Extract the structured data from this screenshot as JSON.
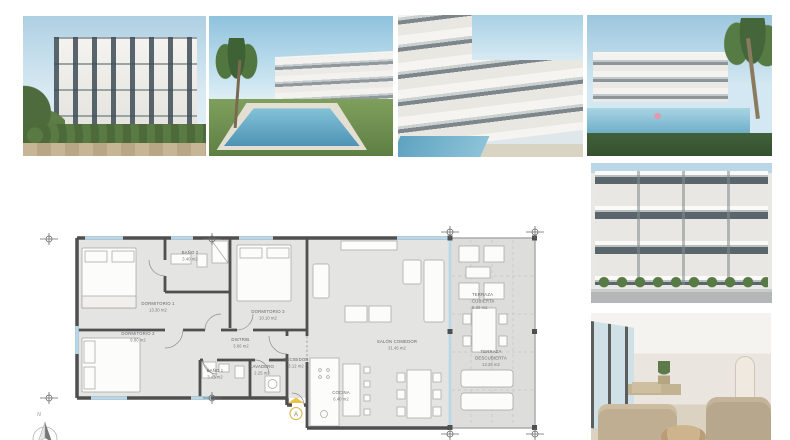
{
  "gallery": {
    "photos": [
      {
        "desc": "apartment building exterior render, angled view with garden"
      },
      {
        "desc": "residential building with swimming pool, lawn and palm tree"
      },
      {
        "desc": "terraced apartment facade with pool, angled view"
      },
      {
        "desc": "building rear view with pool, palm tree and pink float"
      },
      {
        "desc": "straight-on facade with stacked terraces and planting"
      },
      {
        "desc": "living room interior with beige sofas and round rattan table"
      }
    ]
  },
  "floorplan": {
    "compass_label": "N",
    "entrance_label": "A",
    "rooms": {
      "dormitorio1": {
        "name": "DORMITORIO 1",
        "area": "13.30 m2"
      },
      "banio2": {
        "name": "BAÑO 2",
        "area": "3.40 m2"
      },
      "dormitorio3": {
        "name": "DORMITORIO 3",
        "area": "10.10 m2"
      },
      "dormitorio2": {
        "name": "DORMITORIO 2",
        "area": "9.80 m2"
      },
      "distrib": {
        "name": "DISTRIB.",
        "area": "3.66 m2"
      },
      "banio1": {
        "name": "BAÑO 1",
        "area": "3.45 m2"
      },
      "lavadero": {
        "name": "LAVADERO",
        "area": "2.25 m2"
      },
      "recibidor": {
        "name": "RECIBIDOR",
        "area": "3.12 m2"
      },
      "cocina": {
        "name": "COCINA",
        "area": "6.40 m2"
      },
      "salon": {
        "name": "SALÓN COMEDOR",
        "area": "31.45 m2"
      },
      "terraza_cubierta": {
        "line1": "TERRAZA",
        "line2": "CUBIERTA",
        "area": "9.30 m2"
      },
      "terraza_descubierta": {
        "line1": "TERRAZA",
        "line2": "DESCUBIERTA",
        "area": "13.28 m2"
      }
    },
    "colors": {
      "wall": "#4f4f4f",
      "floor": "#e4e4e3",
      "glass": "#b8d8e8",
      "accent": "#edc24a"
    }
  }
}
